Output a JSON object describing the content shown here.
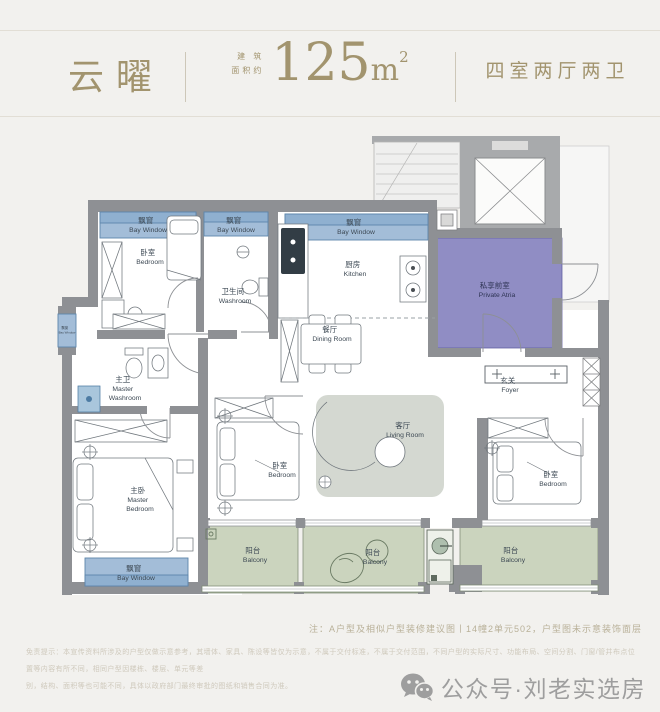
{
  "header": {
    "project_name": "云曜",
    "area_label_line1": "建 筑",
    "area_label_line2": "面积约",
    "area_value": "125",
    "area_unit": "m",
    "area_superscript": "2",
    "layout_type": "四室两厅两卫"
  },
  "rooms": {
    "bay_window": {
      "cn": "飘窗",
      "en": "Bay Window"
    },
    "bedroom": {
      "cn": "卧室",
      "en": "Bedroom"
    },
    "washroom": {
      "cn": "卫生间",
      "en": "Washroom"
    },
    "kitchen": {
      "cn": "厨房",
      "en": "Kitchen"
    },
    "dining_room": {
      "cn": "餐厅",
      "en": "Dining Room"
    },
    "private_atria": {
      "cn": "私享前室",
      "en": "Private Atria"
    },
    "foyer": {
      "cn": "玄关",
      "en": "Foyer"
    },
    "master_washroom": {
      "cn": "主卫",
      "en_line1": "Master",
      "en_line2": "Washroom"
    },
    "master_bedroom": {
      "cn": "主卧",
      "en_line1": "Master",
      "en_line2": "Bedroom"
    },
    "living_room": {
      "cn": "客厅",
      "en": "Living Room"
    },
    "balcony": {
      "cn": "阳台",
      "en": "Balcony"
    }
  },
  "notes": {
    "plan_note": "注：A户型及相似户型装修建议图丨14幢2单元502，户型图未示意装饰面层",
    "disclaimer_line1": "免责提示：本宣传资料所涉及的户型仅做示意参考，其墙体、家具、陈设等皆仅为示意，不属于交付标准，不属于交付范围，不同户型的实际尺寸、功能布局、空间分割、门窗/管井布点位置等内容有所不同，相同户型因楼栋、楼层、单元等差",
    "disclaimer_line2": "别，结构、面积等也可能不同，具体以政府部门最终审批的图纸和销售合同为准。"
  },
  "footer": {
    "wechat_account": "公众号·刘老实选房"
  },
  "colors": {
    "accent_gold": "#a2946e",
    "bay_window_blue": "#a3bdd8",
    "balcony_green": "#cbd4be",
    "atria_purple": "#908dc4",
    "wall_gray": "#8e9094",
    "label_slate": "#3d4954"
  }
}
